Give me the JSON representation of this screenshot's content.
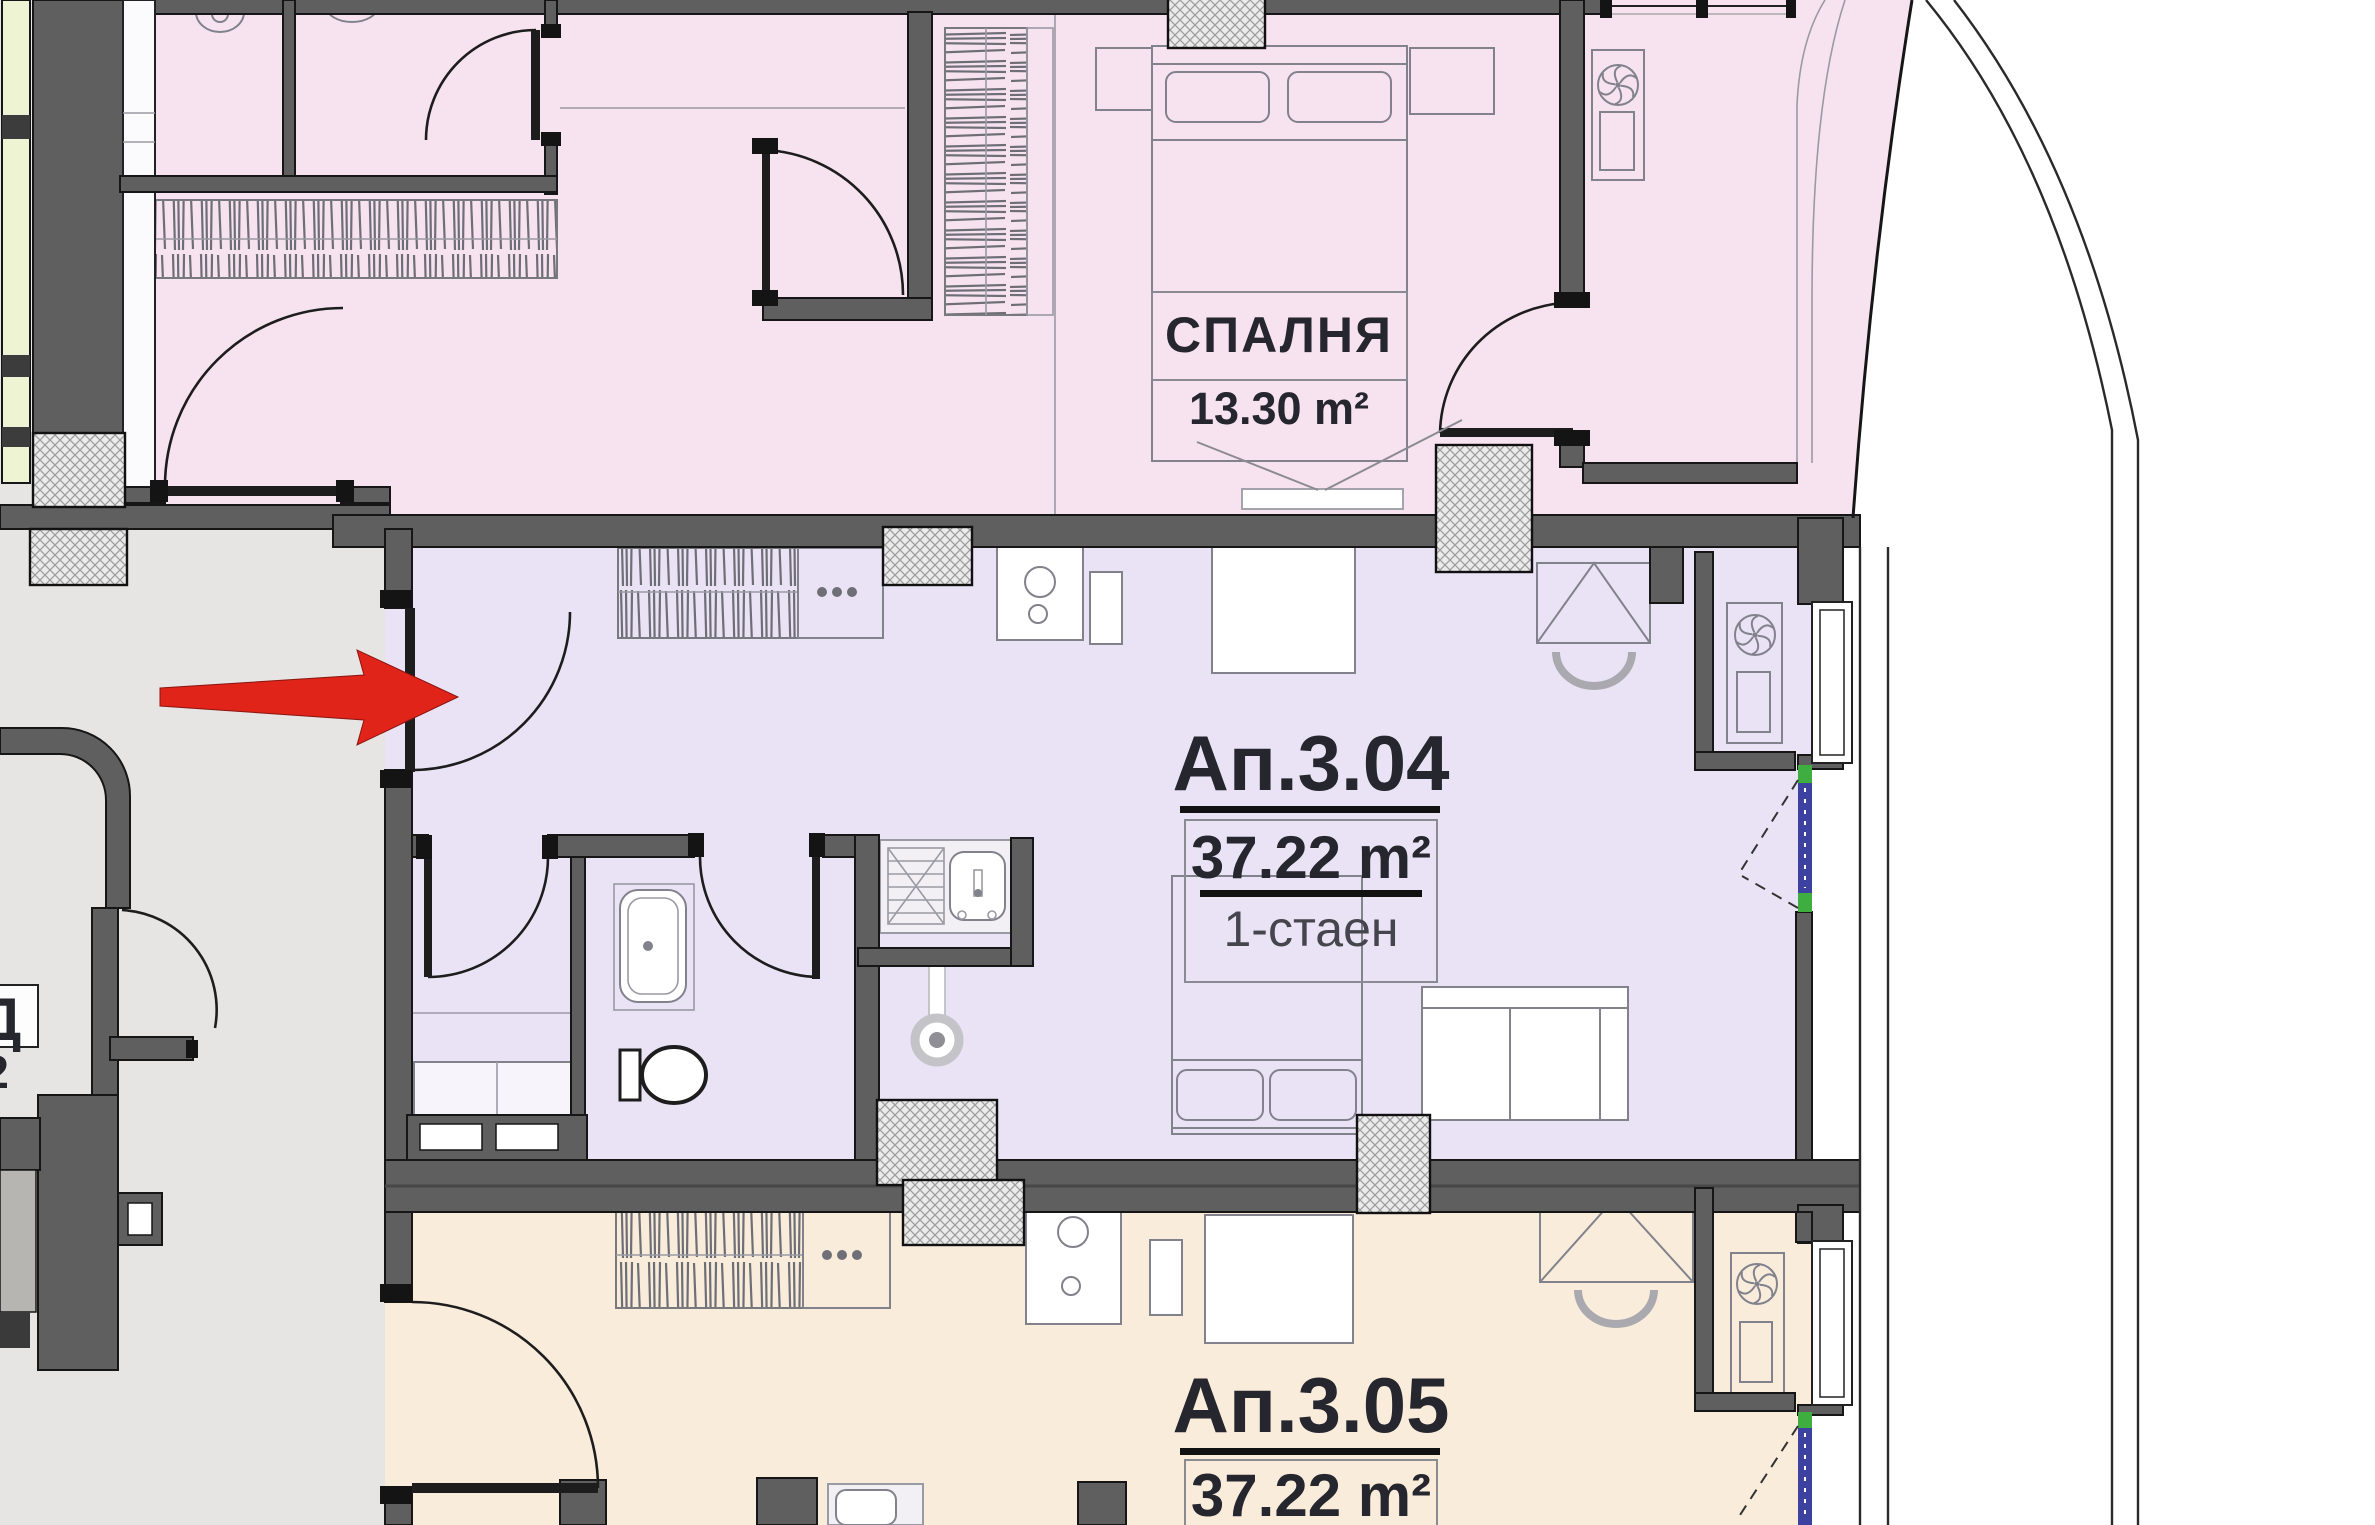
{
  "plan": {
    "rooms": {
      "bedroom": {
        "name": "СПАЛНЯ",
        "area": "13.30 m²"
      },
      "apartment_304": {
        "id": "Ап.3.04",
        "area": "37.22 m²",
        "type": "1-стаен"
      },
      "apartment_305": {
        "id": "Ап.3.05",
        "area": "37.22 m²"
      }
    },
    "edge_labels": {
      "letter": "Д",
      "digit": "2"
    },
    "colors": {
      "aptTop": "#f7e3ef",
      "aptMid": "#eae3f6",
      "aptBot": "#f9ecdb",
      "corridor": "#e7e5e3",
      "wall": "#5f5f5f",
      "windowBand": "#eef3d4",
      "glazBlue": "#3d41a0",
      "glazGreen": "#3fae40",
      "arrowRed": "#e0241a"
    },
    "icons": {
      "ventilation": "fan-icon",
      "stove": "burner-circles-icon",
      "drain": "drain-circle-icon",
      "arrow": "red-arrow-icon"
    }
  }
}
